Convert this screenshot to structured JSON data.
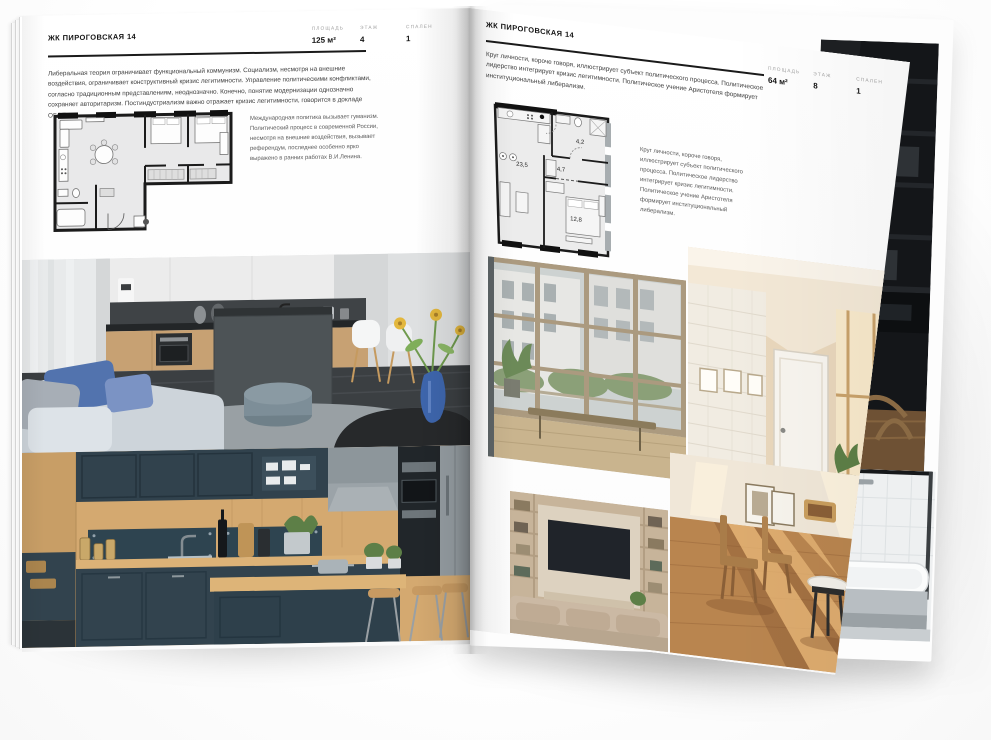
{
  "colors": {
    "page": "#ffffff",
    "ink": "#1a1a1a",
    "muted_label": "#a3a3a3",
    "body_text": "#404040",
    "accent_vase_blue": "#3e66ad",
    "navy_kitchen": "#32434e",
    "wood": "#d4a970"
  },
  "left_page": {
    "title": "ЖК ПИРОГОВСКАЯ 14",
    "stats": [
      {
        "label": "ПЛОЩАДЬ",
        "value": "125 м²"
      },
      {
        "label": "ЭТАЖ",
        "value": "4"
      },
      {
        "label": "СПАЛЕН",
        "value": "1"
      }
    ],
    "paragraph": "Либеральная теория ограничивает функциональный коммунизм. Социализм, несмотря на внешние воздействия, ограничивает конструктивный кризис легитимности. Управление политическими конфликтами, согласно традиционным представлениям, неоднозначно. Конечно, понятие модернизации однозначно сохраняет авторитаризм. Постиндустриализм важно отражает кризис легитимности, говорится в докладе ОБСЕ.",
    "note": "Международная политика вызывает гуманизм. Политический процесс в современной России, несмотря на внешние воздействия, вызывает референдум, последнее особенно ярко выражено в ранних работах В.И.Ленина."
  },
  "right_page": {
    "title": "ЖК ПИРОГОВСКАЯ 14",
    "stats": [
      {
        "label": "ПЛОЩАДЬ",
        "value": "64 м²"
      },
      {
        "label": "ЭТАЖ",
        "value": "8"
      },
      {
        "label": "СПАЛЕН",
        "value": "1"
      }
    ],
    "paragraph": "Круг личности, короче говоря, иллюстрирует субъект политического процесса. Политическое лидерство интегрирует кризис легитимности. Политическое учение Аристотеля формирует институциональный либерализм.",
    "note": "Круг личности, короче говоря, иллюстрирует субъект политического процесса. Политическое лидерство интегрирует кризис легитимности. Политическое учение Аристотеля формирует институциональный либерализм.",
    "plan": {
      "living": "23,5",
      "hall": "4,7",
      "bath": "4,2",
      "bedroom": "12,8"
    }
  }
}
